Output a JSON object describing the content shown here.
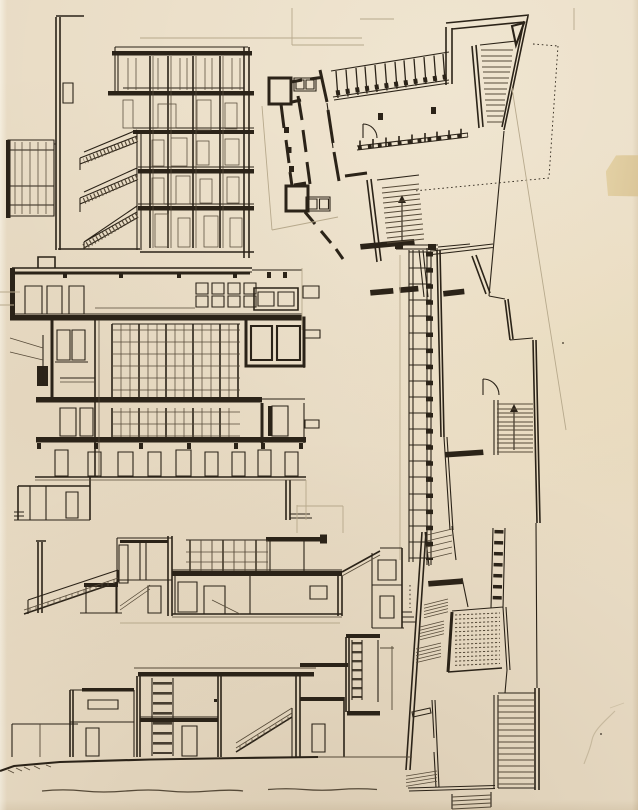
{
  "document": {
    "kind": "hand-drawn architectural sketch sheet",
    "visible_text": ""
  },
  "colors": {
    "paper": "#e9dcc5",
    "paper_highlight": "#f4ecda",
    "paper_shadow": "#d9c9ad",
    "ink_strong": "#2b2318",
    "ink_medium": "#564a38",
    "pencil": "#b7a98c",
    "tape": "#e2cfa0"
  },
  "figures": [
    {
      "id": "section-upper-left",
      "description": "Building cross-section with three descending stair flights, stacked floor slabs and a mullioned glazed shaft at the left"
    },
    {
      "id": "plan-upper-right",
      "description": "Angled floor plan with thick-walled room cluster, slanted colonnade rows, triangular corner stair and dotted setback lines"
    },
    {
      "id": "section-middle-left",
      "description": "Large multi-storey building section with dense central glazing grid, heavy floor slabs and annex rooms"
    },
    {
      "id": "plan-right-strip",
      "description": "Long angled plan strip with ladder-like colonnade, interior stairs, hatched ramp block and large bottom staircase"
    },
    {
      "id": "section-lower-middle",
      "description": "Section with long diagonal exterior stair, clerestory glazing band and floating canopy slab"
    },
    {
      "id": "section-bottom",
      "description": "Low section on a ground line with vertical glazing ladder, interior stair and stepped annexes"
    },
    {
      "id": "ground-baseline",
      "description": "Freehand wavy baseline drawn below the bottom section"
    },
    {
      "id": "tape-patch",
      "description": "Yellowed tape fragment on the right paper edge"
    },
    {
      "id": "paper-marks",
      "description": "Faint pencil crease marks and specks on the blank paper"
    }
  ]
}
